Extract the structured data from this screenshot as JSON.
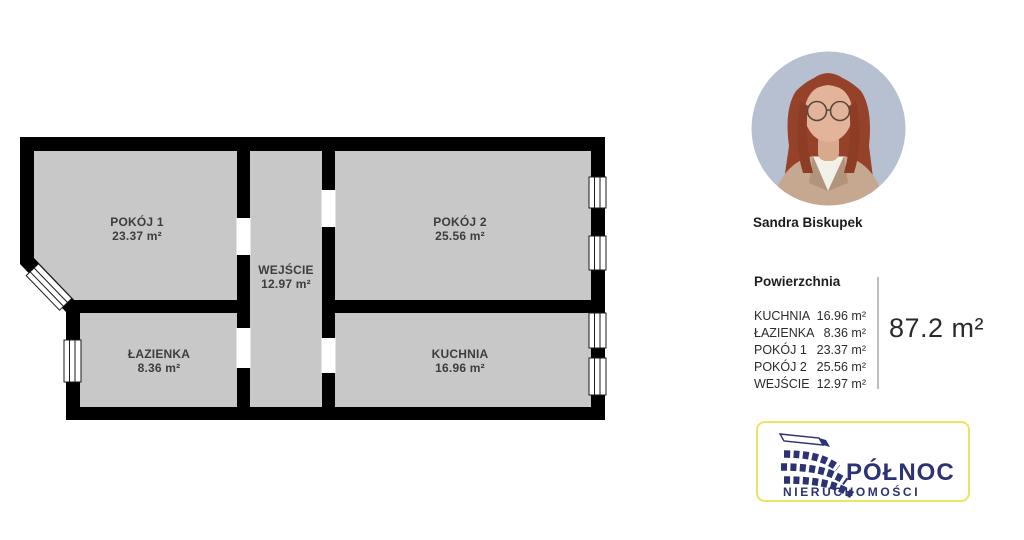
{
  "floorplan": {
    "rooms": [
      {
        "name": "POKÓJ 1",
        "area": "23.37 m²"
      },
      {
        "name": "WEJŚCIE",
        "area": "12.97 m²"
      },
      {
        "name": "POKÓJ 2",
        "area": "25.56 m²"
      },
      {
        "name": "ŁAZIENKA",
        "area": "8.36 m²"
      },
      {
        "name": "KUCHNIA",
        "area": "16.96 m²"
      }
    ],
    "colors": {
      "wall": "#000000",
      "floor": "#c8c8c8",
      "label_text": "#3d3d3d"
    }
  },
  "agent": {
    "name": "Sandra Biskupek"
  },
  "area_panel": {
    "title": "Powierzchnia",
    "rows": [
      {
        "label": "KUCHNIA",
        "value": "16.96 m²"
      },
      {
        "label": "ŁAZIENKA",
        "value": "8.36 m²"
      },
      {
        "label": "POKÓJ 1",
        "value": "23.37 m²"
      },
      {
        "label": "POKÓJ 2",
        "value": "25.56 m²"
      },
      {
        "label": "WEJŚCIE",
        "value": "12.97 m²"
      }
    ],
    "total": "87.2 m²"
  },
  "logo": {
    "line1": "PÓŁNOC",
    "line2": "NIERUCHOMOŚCI",
    "colors": {
      "navy": "#2d3272",
      "border_yellow": "#ebe463"
    }
  }
}
